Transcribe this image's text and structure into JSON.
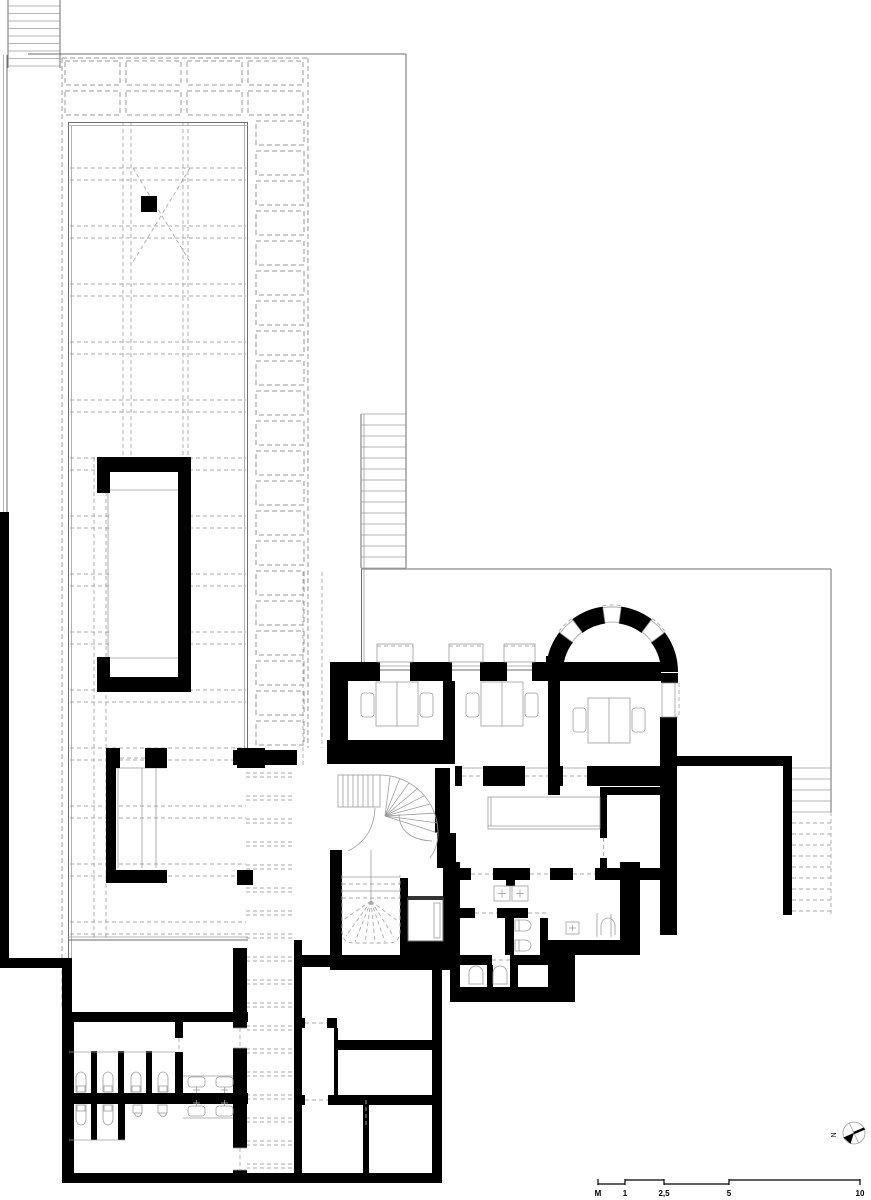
{
  "drawing": {
    "kind": "architectural-floor-plan",
    "colors": {
      "background": "#ffffff",
      "wall": "#000000",
      "thin_line": "#6e6e6e",
      "light_line": "#9c9c9c",
      "dashed_line": "#9a9a9a"
    },
    "icons": [
      "north-arrow-icon",
      "stair-icon",
      "spiral-stair-icon",
      "toilet-icon",
      "sink-icon",
      "urinal-icon",
      "desk-icon",
      "chair-icon",
      "elevator-icon",
      "skylight-icon"
    ]
  },
  "scale_bar": {
    "unit_label": "M",
    "tick_labels": [
      "1",
      "2,5",
      "5",
      "10"
    ]
  },
  "north_arrow": {
    "label": "N"
  }
}
